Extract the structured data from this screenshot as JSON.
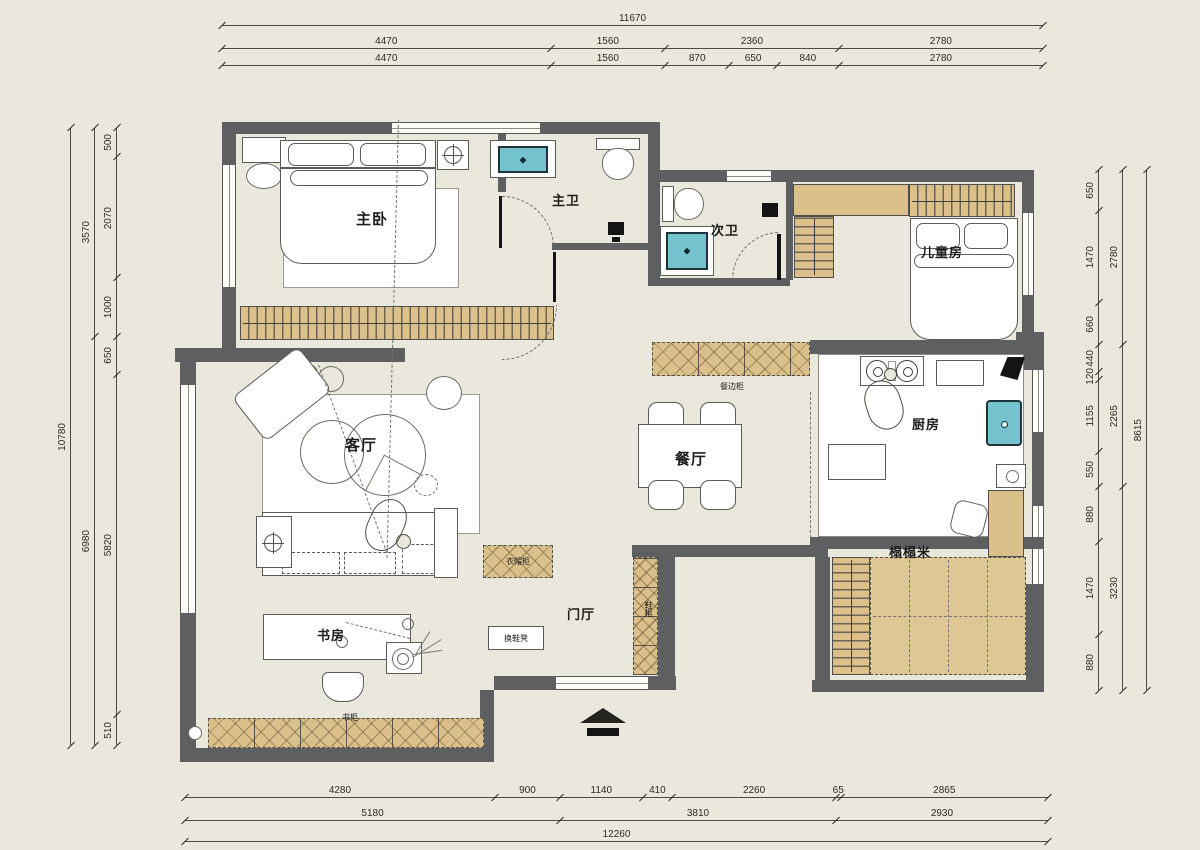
{
  "plan_title": "apartment-floor-plan",
  "colors": {
    "background": "#eae8dc",
    "wall": "#5d5f61",
    "cabinet_wood": "#dcc08b",
    "sink_teal": "#74c3ce",
    "line": "#4a4a46",
    "furniture_fill": "#ffffff"
  },
  "rooms": {
    "master_bedroom": "主卧",
    "master_bath": "主卫",
    "second_bath": "次卫",
    "kids_room": "儿童房",
    "kitchen": "厨房",
    "dining": "餐厅",
    "living": "客厅",
    "study": "书房",
    "foyer": "门厅",
    "tatami": "榻榻米"
  },
  "cabinets": {
    "sideboard": "餐边柜",
    "cloak_cabinet": "衣帽柜",
    "shoe_bench": "换鞋凳",
    "bookcase": "书柜",
    "shoe_cabinet": "鞋柜"
  },
  "dimensions": {
    "top": [
      [
        "11670"
      ],
      [
        "4470",
        "1560",
        "2360",
        "2780"
      ],
      [
        "4470",
        "1560",
        "870",
        "650",
        "840",
        "2780"
      ]
    ],
    "left": [
      [
        "10780"
      ],
      [
        "3570",
        "6980"
      ],
      [
        "500",
        "2070",
        "1000",
        "650",
        "5820",
        "510"
      ]
    ],
    "right": [
      [
        "650",
        "1470",
        "660",
        "440",
        "120",
        "1155",
        "550",
        "880",
        "1470",
        "880"
      ],
      [
        "2780",
        "2265",
        "3230"
      ],
      [
        "8615"
      ]
    ],
    "bottom": [
      [
        "4280",
        "900",
        "1140",
        "410",
        "2260",
        "65",
        "2865"
      ],
      [
        "5180",
        "3810",
        "2930"
      ],
      [
        "12260"
      ]
    ]
  }
}
